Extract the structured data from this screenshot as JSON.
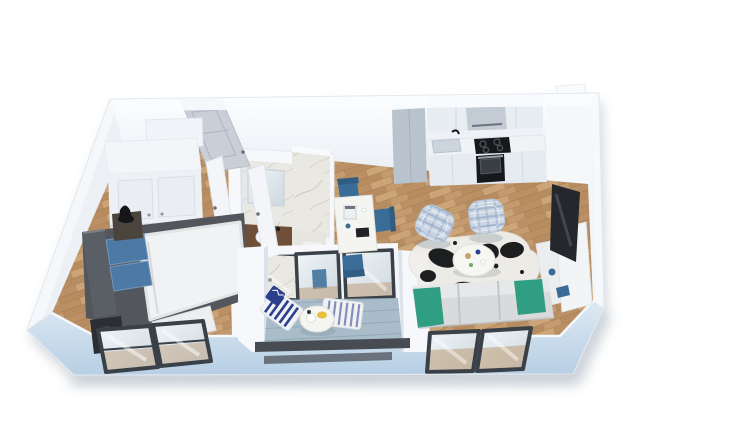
{
  "meta": {
    "description": "Photorealistic 3D isometric cutaway rendering of a one-bedroom apartment floor plan on a white background",
    "view": "top-down oblique, no text labels visible"
  },
  "colors": {
    "page_bg": "#ffffff",
    "shadow": "#8e9ca9",
    "wall_top": "#f6f8fb",
    "wall_face": "#edf1f6",
    "wall_face_shade": "#dbe2ea",
    "wall_blue": "#bed4e7",
    "wall_blue_light": "#dce8f3",
    "wood1": "#c49b6f",
    "wood2": "#bb9065",
    "wood3": "#cba478",
    "wood4": "#b78c60",
    "wood_line": "#9e7950",
    "bath_floor": "#e7e5e0",
    "marble_base": "#eae8e3",
    "marble_vein": "#c9c3b8",
    "deck": "#a8bdc9",
    "deck_line": "#93a9b7",
    "frame_dark": "#3a4047",
    "glass": "#dfe7ec",
    "door_grey": "#c9ced7",
    "door_white": "#f3f5f8",
    "wardrobe": "#edf1f6",
    "dresser": "#f1f4f8",
    "bed_frame": "#53575d",
    "pillow_blue": "#4d79a6",
    "duvet": "#f1f2f4",
    "nightstand": "#4b443c",
    "speaker_black": "#2b2e33",
    "cab_tall": "#b9c3ce",
    "cab_upper": "#e8edf2",
    "counter": "#f0f3f6",
    "appliance_black": "#17181b",
    "hood": "#c3cbd4",
    "sink_grey": "#ccd5dd",
    "chair_blue": "#3a6c98",
    "chair_blue_dark": "#315d83",
    "table_white": "#f4f5f1",
    "teal": "#2f9e82",
    "sofa": "#d8dadc",
    "sofa_light": "#e7e8ea",
    "plaid": "#ccd7e3",
    "plaid_line": "#9fb3cd",
    "rug_white": "#f0efeb",
    "rug_black": "#1d1e20",
    "navy": "#2c3f8e",
    "stripe_white": "#f0f2f4",
    "lemon": "#e6c23c",
    "vanity_wood": "#6f4f38",
    "tv_dark": "#24272c",
    "railing_dark": "#474c53"
  },
  "scene": {
    "rooms": [
      {
        "id": "bedroom",
        "furniture": [
          "wardrobe",
          "dresser",
          "double-bed",
          "blue-pillows",
          "nightstand",
          "speaker-box",
          "corner-windows"
        ]
      },
      {
        "id": "bathroom",
        "furniture": [
          "marble-walls",
          "mirror",
          "wood-vanity-sink",
          "toilet",
          "walk-in-shower"
        ]
      },
      {
        "id": "hallway",
        "furniture": [
          "entry-door-open",
          "bedroom-door-open",
          "bathroom-door-open"
        ]
      },
      {
        "id": "dining-nook",
        "furniture": [
          "white-table",
          "coffee-machine",
          "three-blue-chairs"
        ]
      },
      {
        "id": "kitchen",
        "furniture": [
          "tall-fridge-unit",
          "upper-cabinets",
          "range-hood",
          "sink",
          "black-cooktop",
          "black-oven",
          "base-cabinets"
        ]
      },
      {
        "id": "living-room",
        "furniture": [
          "cowhide-rug",
          "round-coffee-table",
          "two-plaid-armchairs",
          "grey-sofa-teal-cushions",
          "white-chaise",
          "tv",
          "media-console",
          "windows"
        ]
      },
      {
        "id": "balcony",
        "furniture": [
          "round-table-with-lemons",
          "two-striped-loungers",
          "navy-pillow",
          "dark-railing",
          "glass-doors"
        ]
      }
    ]
  }
}
